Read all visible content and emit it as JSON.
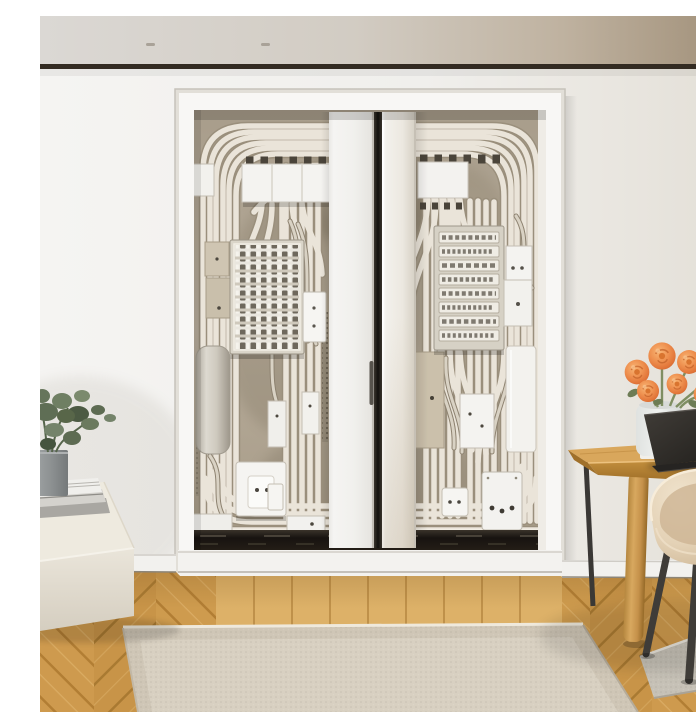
{
  "scene": {
    "caption": "Bright modern room: open double closet doors reveal a wall densely packed with white electrical conduits, a circuit breaker panel, a labelled terminal panel, junction boxes and outlets. At right a light oak desk holds an open dark laptop, a vase of orange ranunculus and a cream bottle, with a beige shell chair on black legs. At left a green plant and stacked books sit on a cream pouf. Oak herringbone parquet with a straight plank border, a large beige rug and a grey runner cover the floor."
  },
  "objects": {
    "ceiling": "ceiling with recessed lights",
    "ceiling_gap": "dark ceiling shadow gap",
    "lights": "recessed ceiling lights",
    "wall": "white plaster wall",
    "closet": "double-door utility closet",
    "closet_frame": "white closet frame and trim",
    "interior": "closet interior packed with electrical conduits",
    "conduits": "white electrical conduits and cables",
    "breaker_panel": "circuit breaker panel",
    "label_panel": "labelled terminal panel",
    "cabinet": "white cabinet box",
    "boxes": "junction boxes and outlets",
    "left_door": "left sliding door",
    "right_door": "right sliding door",
    "door_handle": "recessed door handle",
    "door_track": "dark floor track",
    "threshold": "white threshold sill",
    "baseboard": "white baseboard",
    "floor": "oak herringbone parquet floor",
    "plank_border": "straight plank border",
    "rug": "beige area rug",
    "runner": "grey runner rug",
    "pouf": "cream upholstered pouf",
    "books": "stack of books",
    "plant": "green potted plant",
    "pot": "grey plant pot",
    "desk": "light oak writing desk",
    "desk_wood_leg": "turned wooden desk leg",
    "desk_metal_leg": "thin black metal desk leg",
    "laptop": "open dark laptop",
    "cup": "small white cup",
    "vase": "glass vase",
    "flowers": "orange ranunculus bouquet",
    "bottle": "cream ceramic bottle",
    "chair": "beige shell chair with black legs"
  },
  "colors": {
    "ceiling_left": "#dbd8d4",
    "ceiling_right": "#a08f78",
    "gap_line": "#332b22",
    "wall": "#f3f2ef",
    "wall_right": "#e3dfd7",
    "frame_white": "#f8f7f5",
    "interior_bg": "#b4aa99",
    "conduit_light": "#eae4d9",
    "conduit_shadow": "#9a8f7c",
    "box_white": "#f4f3f0",
    "box_beige": "#ccc2ae",
    "door_white": "#f1f0ed",
    "track_dark": "#171310",
    "wood": "#cd9a4e",
    "plank_light": "#ddb168",
    "rug": "#d2c9b9",
    "runner": "#c6c1b6",
    "pouf": "#e8e3d8",
    "chair_shell": "#e6d6bd",
    "chair_legs": "#3f3c38",
    "desk_top": "#d9a75c",
    "flower_orange": "#ef9251",
    "laptop": "#2e2b28",
    "plant_green": "#5f6e55",
    "pot_gray": "#8f9394",
    "bottle": "#d9c8b2"
  }
}
